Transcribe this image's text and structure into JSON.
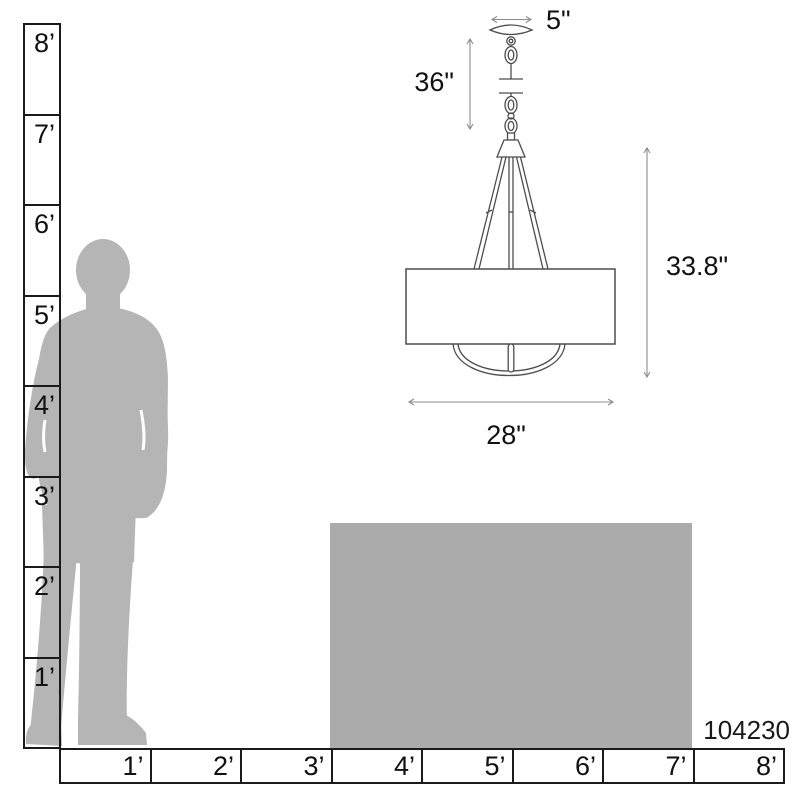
{
  "product": {
    "model_number": "104230"
  },
  "dimensions": {
    "canopy_width": "5\"",
    "chain_length": "36\"",
    "fixture_height": "33.8\"",
    "fixture_width": "28\""
  },
  "rulers": {
    "vertical": {
      "labels": [
        "8’",
        "7’",
        "6’",
        "5’",
        "4’",
        "3’",
        "2’",
        "1’"
      ]
    },
    "horizontal": {
      "labels": [
        "1’",
        "2’",
        "3’",
        "4’",
        "5’",
        "6’",
        "7’",
        "8’"
      ]
    }
  },
  "icons": {
    "person": "standing-man-silhouette",
    "table": "table-height-block",
    "fixture": "drum-pendant-line-drawing",
    "arrows": "double-headed-dimension-arrow"
  },
  "colors": {
    "background": "#ffffff",
    "silhouette_gray": "#b5b5b5",
    "table_gray": "#ababab",
    "ruler_line": "#1a1a1a",
    "drawing_line": "#4d4d4d",
    "dimension_line": "#8c8c8c",
    "text": "#111111"
  }
}
